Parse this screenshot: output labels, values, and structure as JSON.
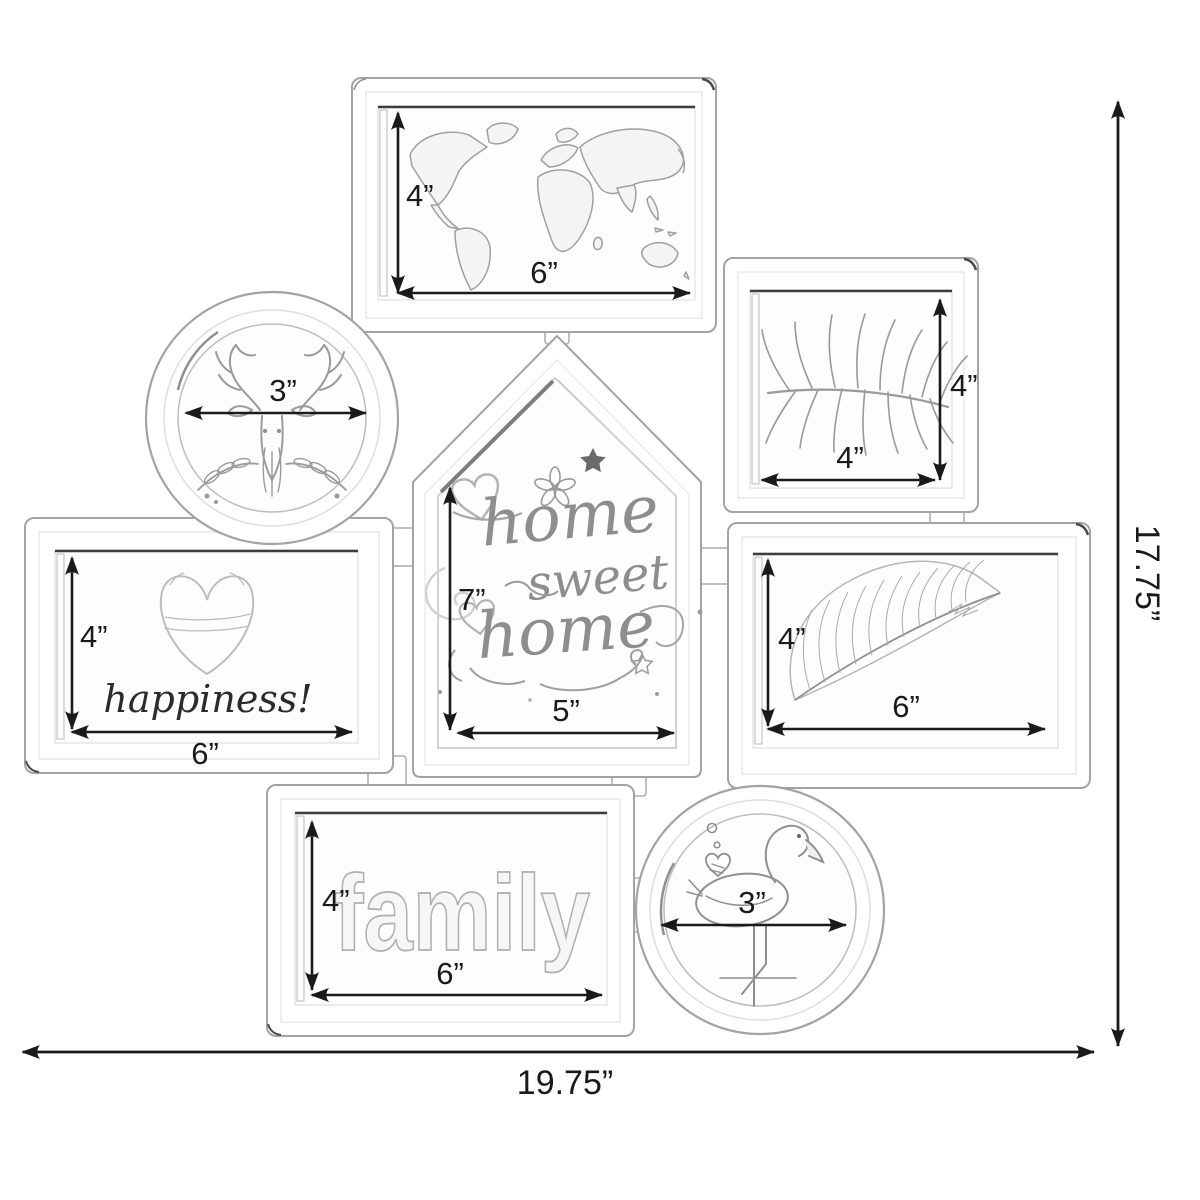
{
  "diagram": {
    "overall": {
      "width_label": "19.75”",
      "height_label": "17.75”"
    },
    "frames": {
      "world_map": {
        "height_label": "4”",
        "width_label": "6”"
      },
      "deer_circle": {
        "diameter_label": "3”"
      },
      "palm_leaf": {
        "height_label": "4”",
        "width_label": "4”"
      },
      "house": {
        "height_label": "7”",
        "width_label": "5”"
      },
      "happiness": {
        "height_label": "4”",
        "width_label": "6”"
      },
      "feather": {
        "height_label": "4”",
        "width_label": "6”"
      },
      "family": {
        "height_label": "4”",
        "width_label": "6”"
      },
      "flamingo_circle": {
        "diameter_label": "3”"
      }
    },
    "art_text": {
      "house_line1": "home",
      "house_line2": "sweet",
      "house_line3": "home",
      "happiness": "happiness!",
      "family": "family"
    },
    "colors": {
      "dimension_line": "#1a1a1a",
      "frame_outline": "#a3a3a3",
      "artwork": "#9a9a9a",
      "background": "#ffffff"
    }
  }
}
